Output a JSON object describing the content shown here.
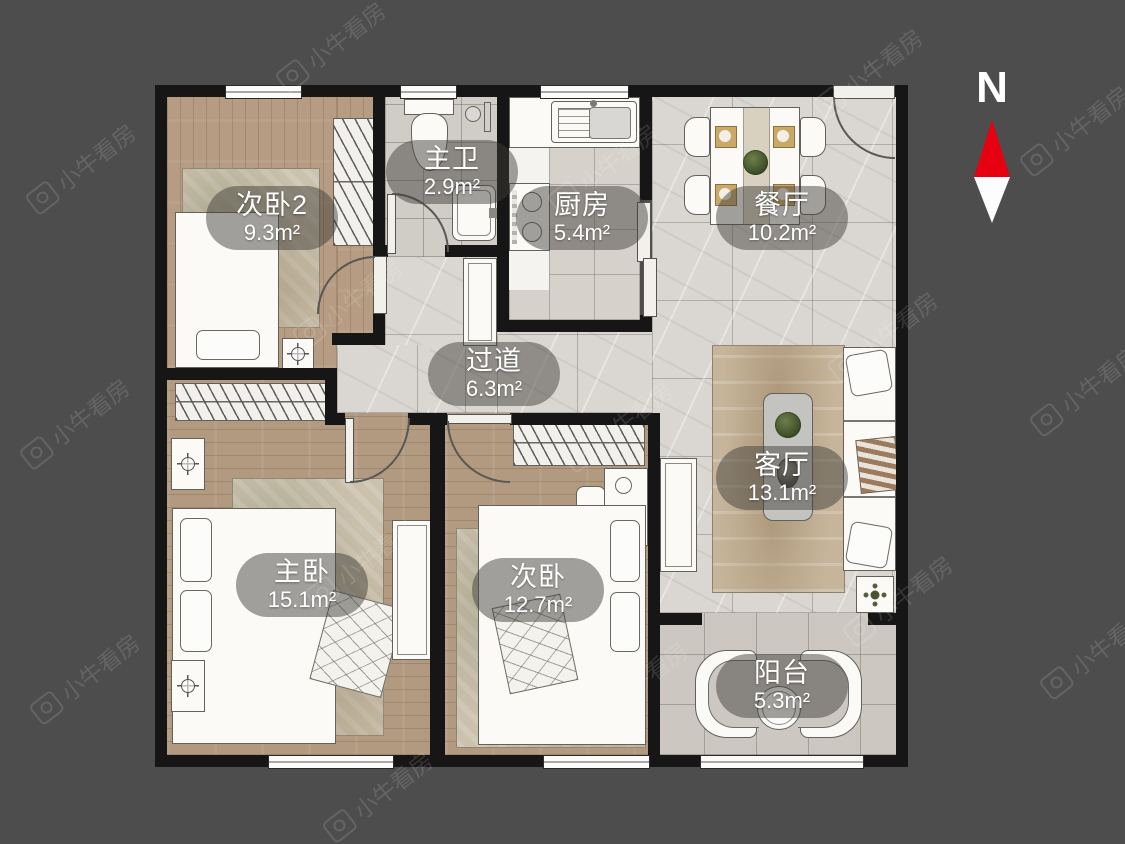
{
  "meta": {
    "background_color": "#4e4d4d",
    "wall_color": "#161616",
    "label_pill_color": "rgba(62,60,57,0.48)",
    "compass_red": "#e60012"
  },
  "compass": {
    "label": "N"
  },
  "watermark": {
    "text": "小牛看房"
  },
  "rooms": [
    {
      "id": "bedroom2",
      "name": "次卧2",
      "area": "9.3m²"
    },
    {
      "id": "master-bath",
      "name": "主卫",
      "area": "2.9m²"
    },
    {
      "id": "kitchen",
      "name": "厨房",
      "area": "5.4m²"
    },
    {
      "id": "dining",
      "name": "餐厅",
      "area": "10.2m²"
    },
    {
      "id": "corridor",
      "name": "过道",
      "area": "6.3m²"
    },
    {
      "id": "living",
      "name": "客厅",
      "area": "13.1m²"
    },
    {
      "id": "master-bedroom",
      "name": "主卧",
      "area": "15.1m²"
    },
    {
      "id": "bedroom",
      "name": "次卧",
      "area": "12.7m²"
    },
    {
      "id": "balcony",
      "name": "阳台",
      "area": "5.3m²"
    }
  ]
}
